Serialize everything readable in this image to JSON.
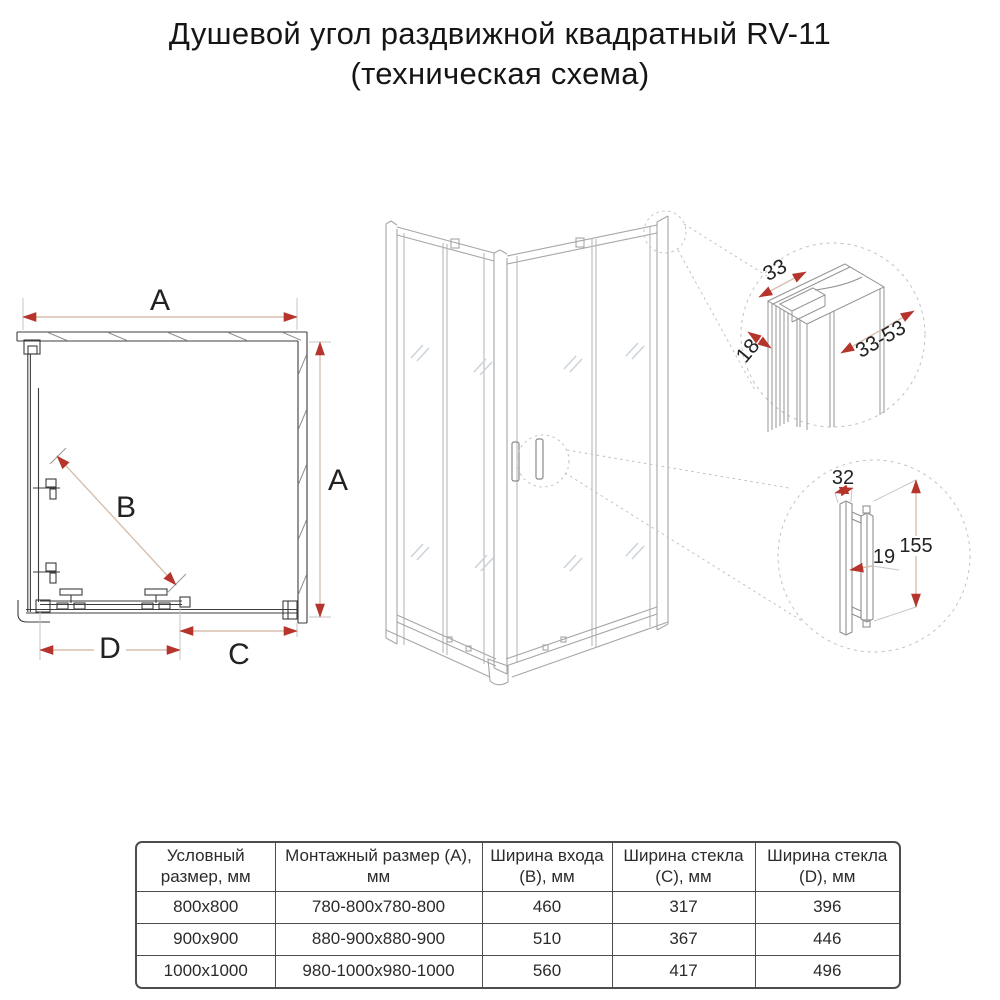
{
  "title": {
    "line1": "Душевой угол раздвижной квадратный RV-11",
    "line2": "(техническая схема)"
  },
  "plan_view": {
    "dim_width_top": "A",
    "dim_height_right": "A",
    "dim_entry_diagonal": "B",
    "dim_fixed_glass_bottom": "C",
    "dim_door_bottom": "D"
  },
  "profile_detail": {
    "dim_profile_width": "33",
    "dim_profile_depth": "18",
    "dim_adjust_range": "33-53"
  },
  "handle_detail": {
    "dim_handle_width": "32",
    "dim_handle_gap": "19",
    "dim_handle_height": "155"
  },
  "table": {
    "headers": [
      "Условный размер, мм",
      "Монтажный размер (А), мм",
      "Ширина входа (В), мм",
      "Ширина стекла (С), мм",
      "Ширина стекла (D), мм"
    ],
    "rows": [
      [
        "800x800",
        "780-800x780-800",
        "460",
        "317",
        "396"
      ],
      [
        "900x900",
        "880-900x880-900",
        "510",
        "367",
        "446"
      ],
      [
        "1000x1000",
        "980-1000x980-1000",
        "560",
        "417",
        "496"
      ]
    ]
  },
  "colors": {
    "dimension_arrow": "#b5352c",
    "dimension_line": "#d8bfae",
    "extension_line": "#c6c6c6",
    "plan_line": "#3c3c3c",
    "iso_line": "#a6a6a6",
    "glass_shine": "#ccd3db",
    "callout_dash": "#c2c2c2",
    "table_border": "#4d4d4d"
  }
}
